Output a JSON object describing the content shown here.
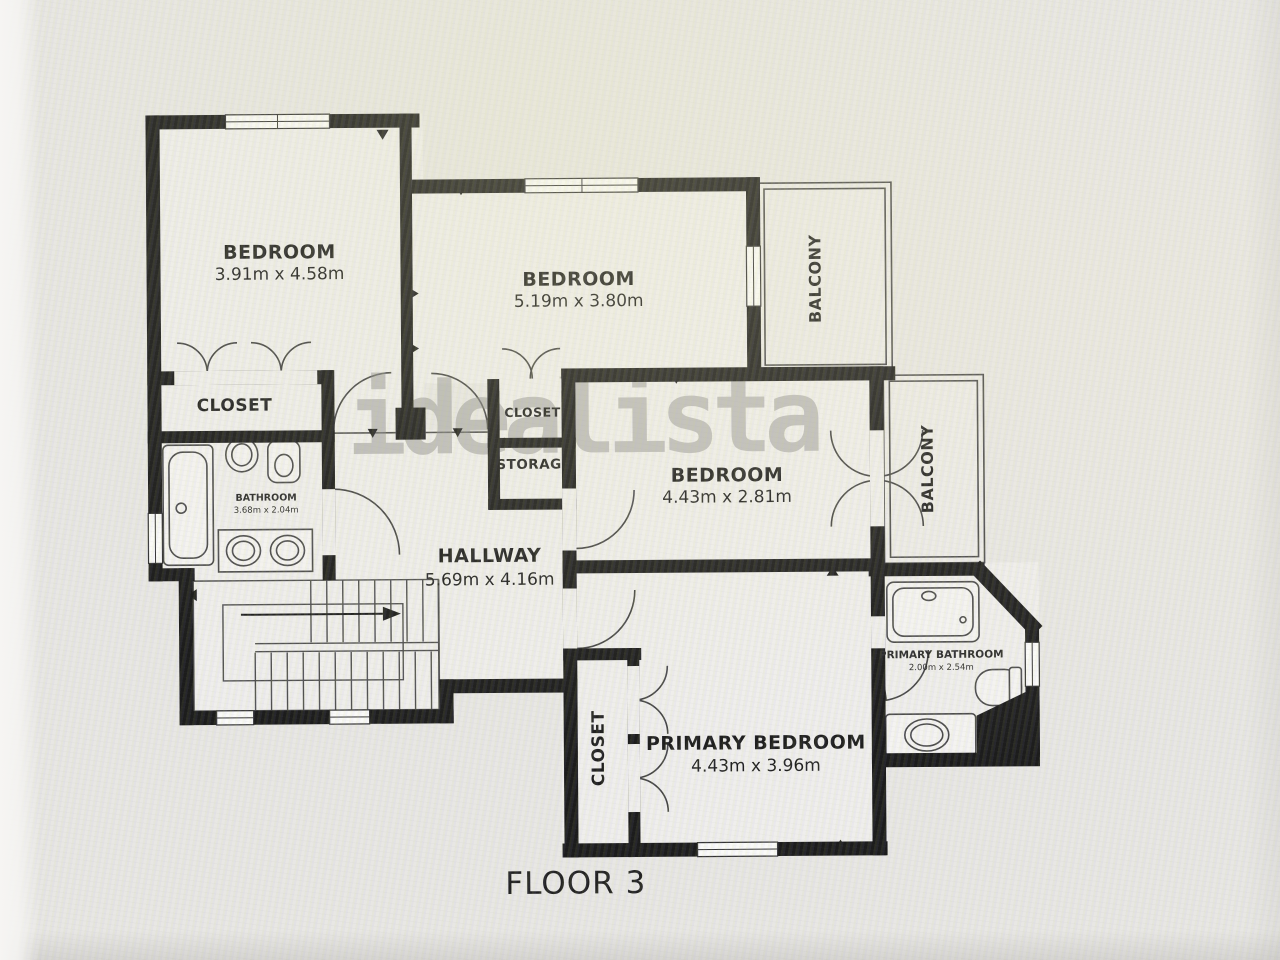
{
  "meta": {
    "floor_label": "FLOOR 3",
    "watermark": "idealista"
  },
  "rooms": {
    "bedroom1": {
      "name": "BEDROOM",
      "dims": "3.91m x 4.58m"
    },
    "bedroom2": {
      "name": "BEDROOM",
      "dims": "5.19m x 3.80m"
    },
    "bedroom3": {
      "name": "BEDROOM",
      "dims": "4.43m x 2.81m"
    },
    "primary_bedroom": {
      "name": "PRIMARY BEDROOM",
      "dims": "4.43m x 3.96m"
    },
    "hallway": {
      "name": "HALLWAY",
      "dims": "5.69m x 4.16m"
    },
    "bathroom": {
      "name": "BATHROOM",
      "dims": "3.68m x 2.04m"
    },
    "primary_bathroom": {
      "name": "PRIMARY BATHROOM",
      "dims": "2.00m x 2.54m"
    },
    "closet_bedroom": {
      "name": "CLOSET"
    },
    "closet_hall": {
      "name": "CLOSET"
    },
    "storage": {
      "name": "STORAGE"
    },
    "closet_primary": {
      "name": "CLOSET"
    },
    "balcony_top": {
      "name": "BALCONY"
    },
    "balcony_side": {
      "name": "BALCONY"
    }
  },
  "colors": {
    "wall": "#1c1c1c",
    "floor": "#efeeec",
    "balcony_floor": "#ecebe8",
    "background": "#e8e7e4",
    "thin_line": "#4a4a4a",
    "watermark": "#8c8c8c"
  }
}
